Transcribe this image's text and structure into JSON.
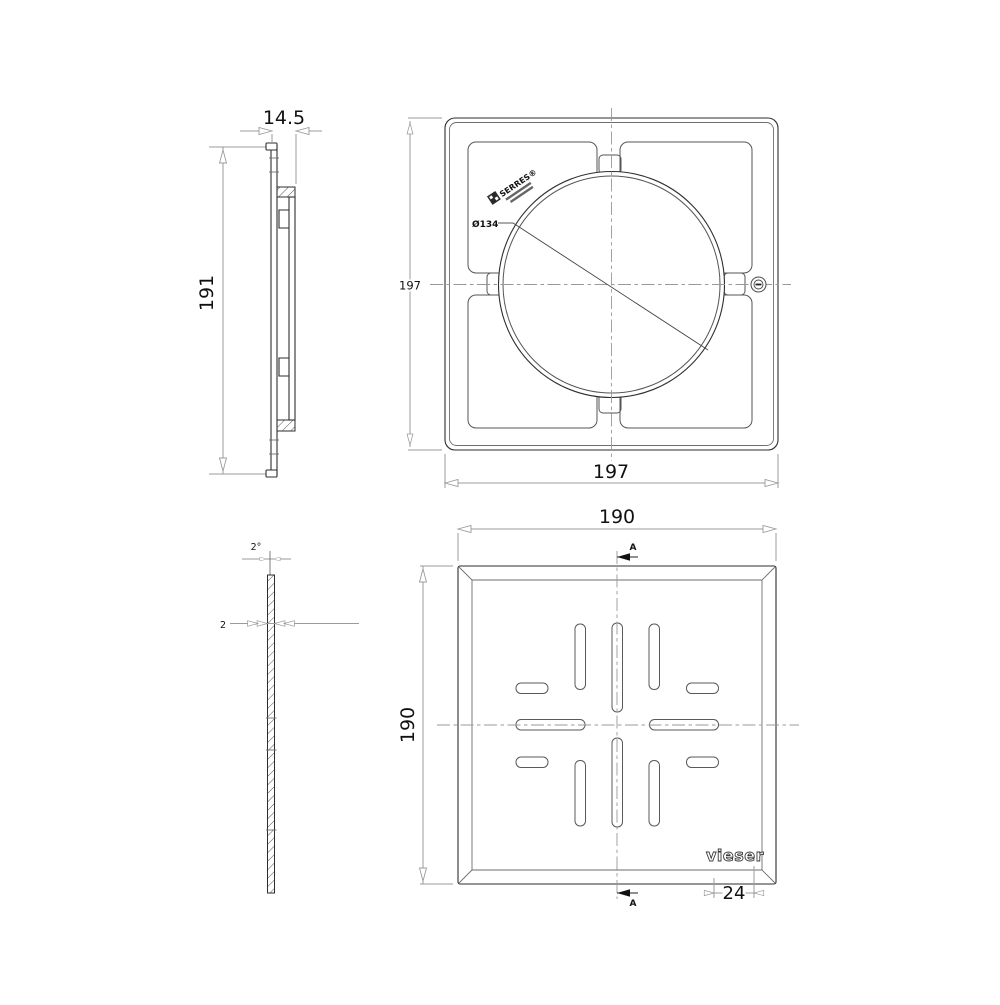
{
  "frame_side_view": {
    "depth_dim": "14.5",
    "height_dim": "191"
  },
  "frame_front_view": {
    "width_dim": "197",
    "height_dim": "197",
    "diameter_label": "Ø134",
    "stamp_brand": "SERRES®"
  },
  "grate_section_view": {
    "draft_angle_dim": "2°",
    "thickness_dim": "2"
  },
  "grate_front_view": {
    "width_dim": "190",
    "height_dim": "190",
    "section_label_top": "A",
    "section_label_bottom": "A",
    "brand_logo": "vieser",
    "logo_width_dim": "24"
  },
  "colors": {
    "background": "#ffffff",
    "part_line": "#2e2e2e",
    "dim_line": "#9b9b9b",
    "text": "#111111"
  }
}
